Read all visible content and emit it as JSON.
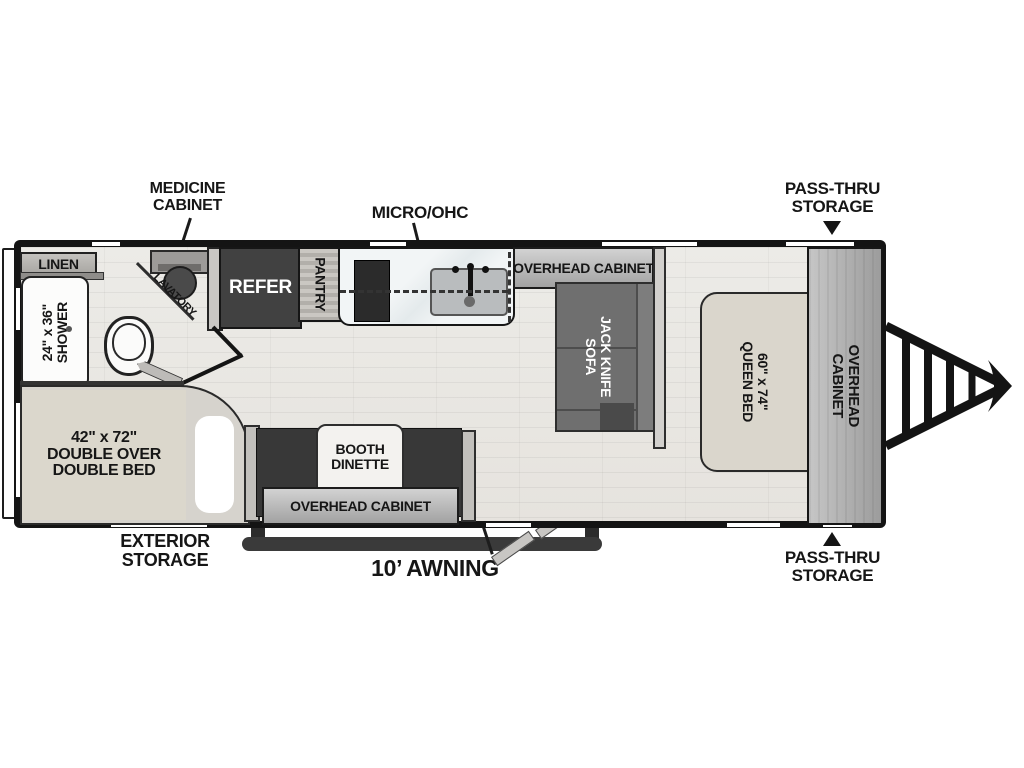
{
  "floorplan": {
    "callouts": {
      "medicine_cabinet": {
        "l1": "MEDICINE",
        "l2": "CABINET"
      },
      "micro_ohc": {
        "l1": "MICRO/OHC"
      },
      "pass_thru_top": {
        "l1": "PASS-THRU",
        "l2": "STORAGE"
      },
      "pass_thru_bottom": {
        "l1": "PASS-THRU",
        "l2": "STORAGE"
      },
      "exterior_storage": {
        "l1": "EXTERIOR",
        "l2": "STORAGE"
      },
      "awning": {
        "l1": "10’ AWNING"
      }
    },
    "areas": {
      "linen": {
        "l1": "LINEN"
      },
      "shower": {
        "l1": "24\" x 36\"",
        "l2": "SHOWER"
      },
      "lavatory": {
        "l1": "LAVATORY"
      },
      "refer": {
        "l1": "REFER"
      },
      "pantry": {
        "l1": "PANTRY"
      },
      "kitchen_overhead_cabinet": {
        "l1": "OVERHEAD CABINET"
      },
      "jack_knife_sofa": {
        "l1": "JACK KNIFE",
        "l2": "SOFA"
      },
      "queen_bed": {
        "l1": "60\" x 74\"",
        "l2": "QUEEN BED"
      },
      "front_overhead_cabinet": {
        "l1": "OVERHEAD",
        "l2": "CABINET"
      },
      "booth_dinette": {
        "l1": "BOOTH",
        "l2": "DINETTE"
      },
      "dinette_overhead_cabinet": {
        "l1": "OVERHEAD CABINET"
      },
      "double_bed": {
        "l1": "42\" x 72\"",
        "l2": "DOUBLE OVER",
        "l3": "DOUBLE BED"
      }
    },
    "icons": {
      "arrow_down": "triangle-down",
      "arrow_up": "triangle-up",
      "hitch": "a-frame-tongue"
    },
    "colors": {
      "wall": "#141414",
      "floor": "#e9e6e1",
      "dark_furniture": "#3c3c3c",
      "sofa": "#6f6f6f",
      "mattress": "#dad6cc",
      "cabinet_gray": "#b9b9b9"
    }
  }
}
